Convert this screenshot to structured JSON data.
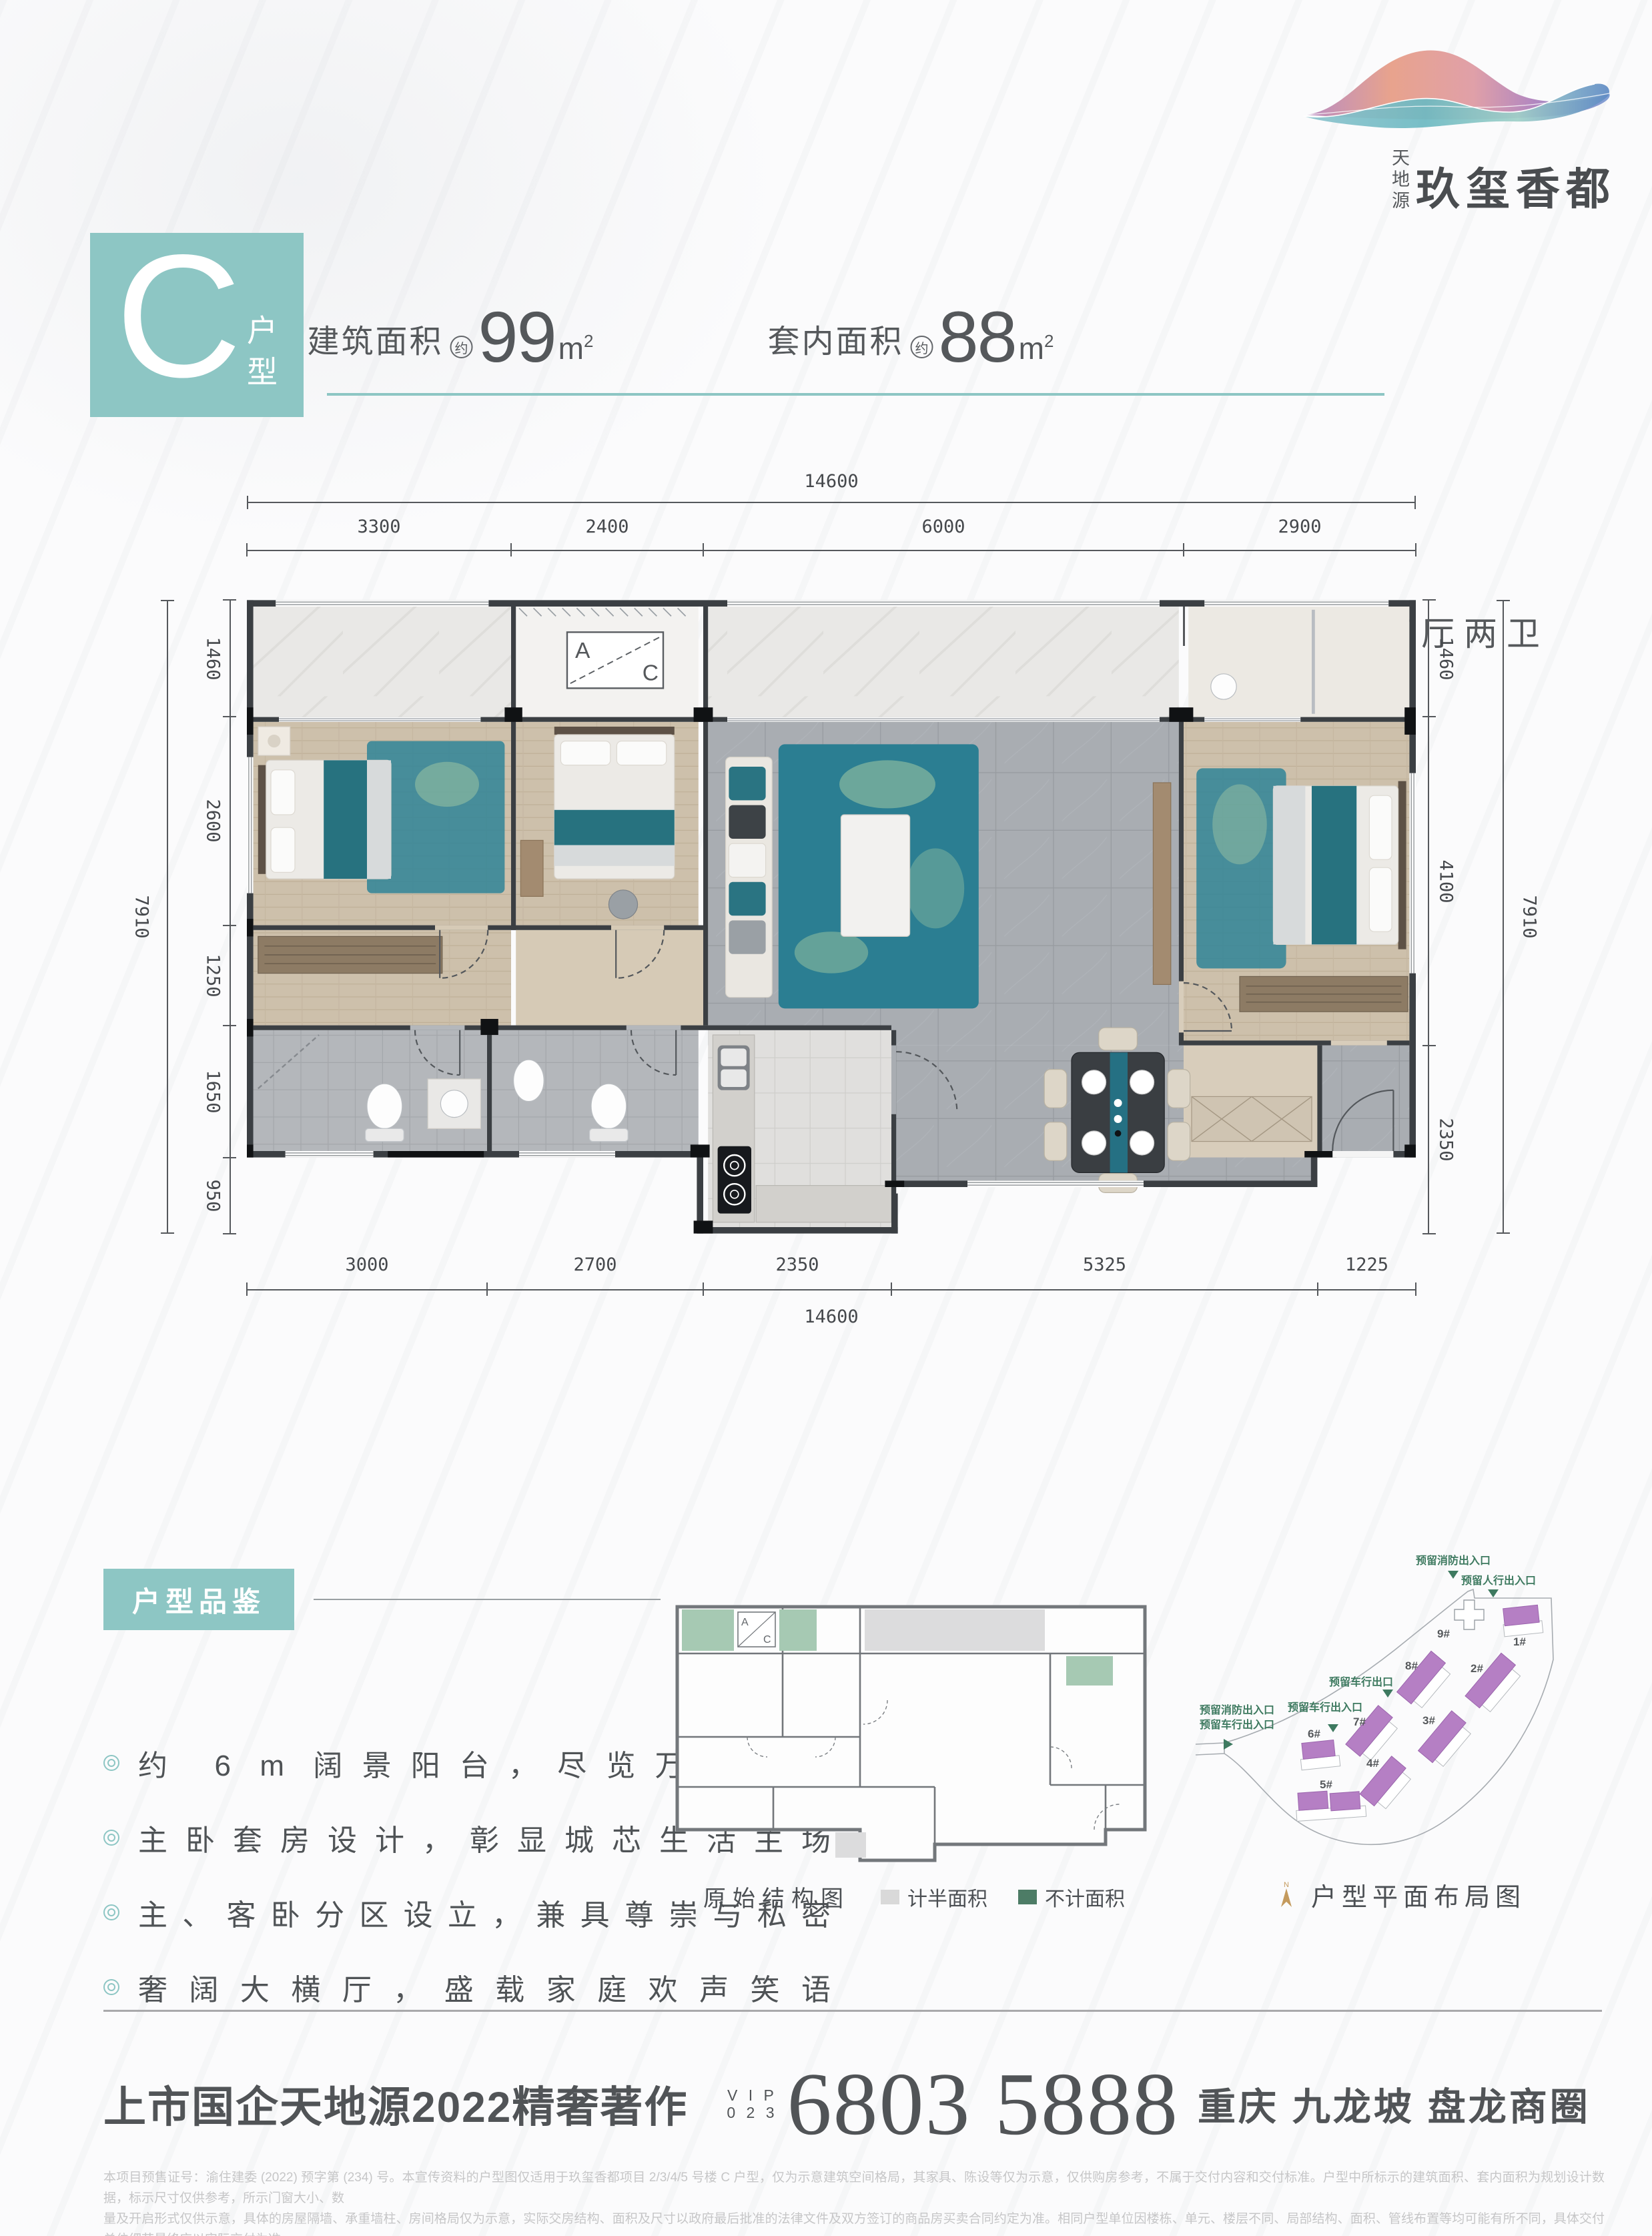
{
  "logo": {
    "company": "天地源",
    "brand": "玖玺香都"
  },
  "header": {
    "type_letter": "C",
    "type_label": "户型",
    "specs": [
      {
        "label": "建筑面积",
        "approx": "约",
        "value": "99",
        "unit": "m",
        "unit_sup": "2"
      },
      {
        "label": "套内面积",
        "approx": "约",
        "value": "88",
        "unit": "m",
        "unit_sup": "2"
      }
    ],
    "layout_text": "三室两厅两卫"
  },
  "plan": {
    "ac_a": "A",
    "ac_c": "C",
    "dims": {
      "top_total": "14600",
      "top_segments": [
        "3300",
        "2400",
        "6000",
        "2900"
      ],
      "left_total": "7910",
      "left_segments": [
        "1460",
        "2600",
        "1250",
        "1650",
        "950"
      ],
      "right_total": "7910",
      "right_segments": [
        "1460",
        "4100",
        "2350"
      ],
      "bottom_segments": [
        "3000",
        "2700",
        "2350",
        "5325",
        "1225"
      ],
      "bottom_total": "14600"
    }
  },
  "highlights": {
    "title": "户型品鉴",
    "items": [
      "约 6 m 阔景阳台，尽览万方中庭",
      "主卧套房设计，彰显城芯生活主场",
      "主、客卧分区设立，兼具尊崇与私密",
      "奢阔大横厅，盛载家庭欢声笑语"
    ]
  },
  "struct": {
    "caption": "原始结构图",
    "legend_half": "计半面积",
    "legend_excluded": "不计面积",
    "ac_a": "A",
    "ac_c": "C"
  },
  "site": {
    "caption": "户型平面布局图",
    "compass": "N",
    "buildings": [
      "1#",
      "2#",
      "3#",
      "4#",
      "5#",
      "6#",
      "7#",
      "8#",
      "9#"
    ],
    "entrances": {
      "fire_top": "预留消防出入口",
      "pedestrian": "预留人行出入口",
      "vehicle_exit": "预留车行出口",
      "vehicle_access": "预留车行出入口",
      "fire_left": "预留消防出入口",
      "vehicle_left": "预留车行出入口"
    }
  },
  "tagline": {
    "left": "上市国企天地源2022精奢著作",
    "vip": "V I P",
    "vip_code": "0 2 3",
    "phone": "6803 5888",
    "location": "重庆 九龙坡 盘龙商圈"
  },
  "disclaimer": {
    "line1": "本项目预售证号：渝住建委 (2022) 预字第 (234) 号。本宣传资料的户型图仅适用于玖玺香都项目 2/3/4/5 号楼 C 户型，仅为示意建筑空间格局，其家具、陈设等仅为示意，仅供购房参考，不属于交付内容和交付标准。户型中所标示的建筑面积、套内面积为规划设计数据，标示尺寸仅供参考，所示门窗大小、数",
    "line2": "量及开启形式仅供示意，具体的房屋隔墙、承重墙柱、房间格局仅为示意，实际交房结构、面积及尺寸以政府最后批准的法律文件及双方签订的商品房买卖合同约定为准。相同户型单位因楼栋、单元、楼层不同、局部结构、面积、管线布置等均可能有所不同，具体交付单位细节最终应以实际交付为准。"
  },
  "colors": {
    "teal": "#8dc6c4",
    "green": "#3e7a60",
    "purple": "#b57fc4",
    "gold": "#c49a5d"
  }
}
